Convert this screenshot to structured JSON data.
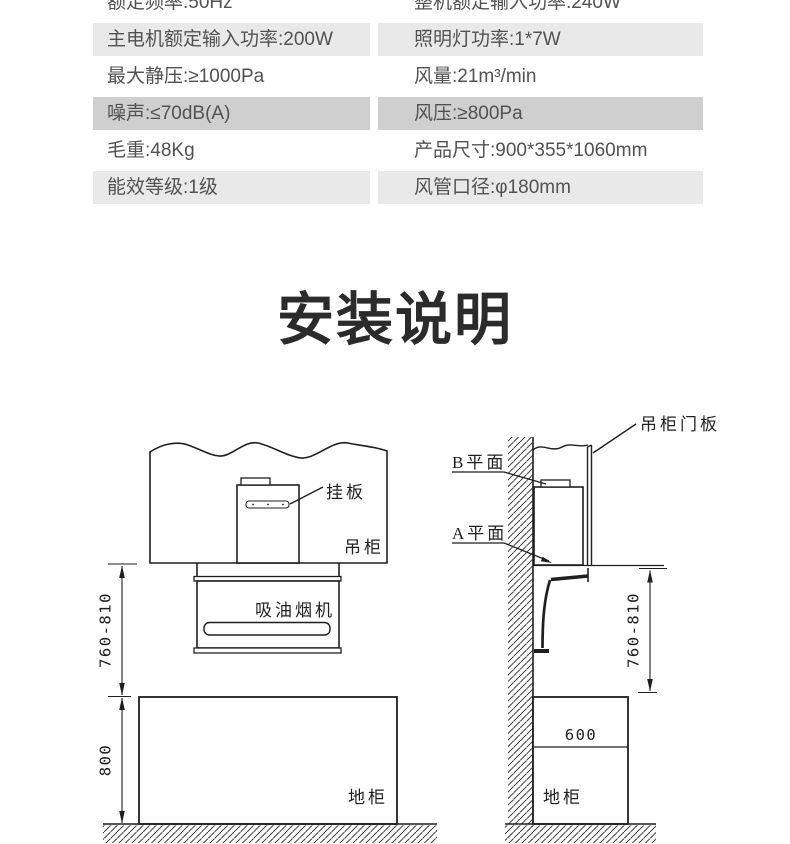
{
  "spec_table": {
    "rows": [
      {
        "left": "额定频率:50Hz",
        "right": "整机额定输入功率:240W",
        "bg": "#ffffff"
      },
      {
        "left": "主电机额定输入功率:200W",
        "right": "照明灯功率:1*7W",
        "bg": "#e9e9e9"
      },
      {
        "left": "最大静压:≥1000Pa",
        "right": "风量:21m³/min",
        "bg": "#ffffff"
      },
      {
        "left": "噪声:≤70dB(A)",
        "right": "风压:≥800Pa",
        "bg": "#cfcfcf"
      },
      {
        "left": "毛重:48Kg",
        "right": "产品尺寸:900*355*1060mm",
        "bg": "#ffffff"
      },
      {
        "left": "能效等级:1级",
        "right": "风管口径:φ180mm",
        "bg": "#e9e9e9"
      }
    ]
  },
  "section_title": "安装说明",
  "diagrams": {
    "front_view": {
      "hang_plate": "挂板",
      "wall_cabinet": "吊柜",
      "range_hood": "吸油烟机",
      "base_cabinet": "地柜",
      "install_height_range": "760-810",
      "base_cabinet_height": "800"
    },
    "side_view": {
      "cabinet_door_panel": "吊柜门板",
      "plane_b": "B平面",
      "plane_a": "A平面",
      "install_height_range": "760-810",
      "base_cabinet_depth": "600",
      "base_cabinet": "地柜"
    }
  },
  "colors": {
    "row_light_gray": "#e9e9e9",
    "row_dark_gray": "#cfcfcf",
    "table_text": "#525252",
    "line_art": "#1f1f1f"
  }
}
